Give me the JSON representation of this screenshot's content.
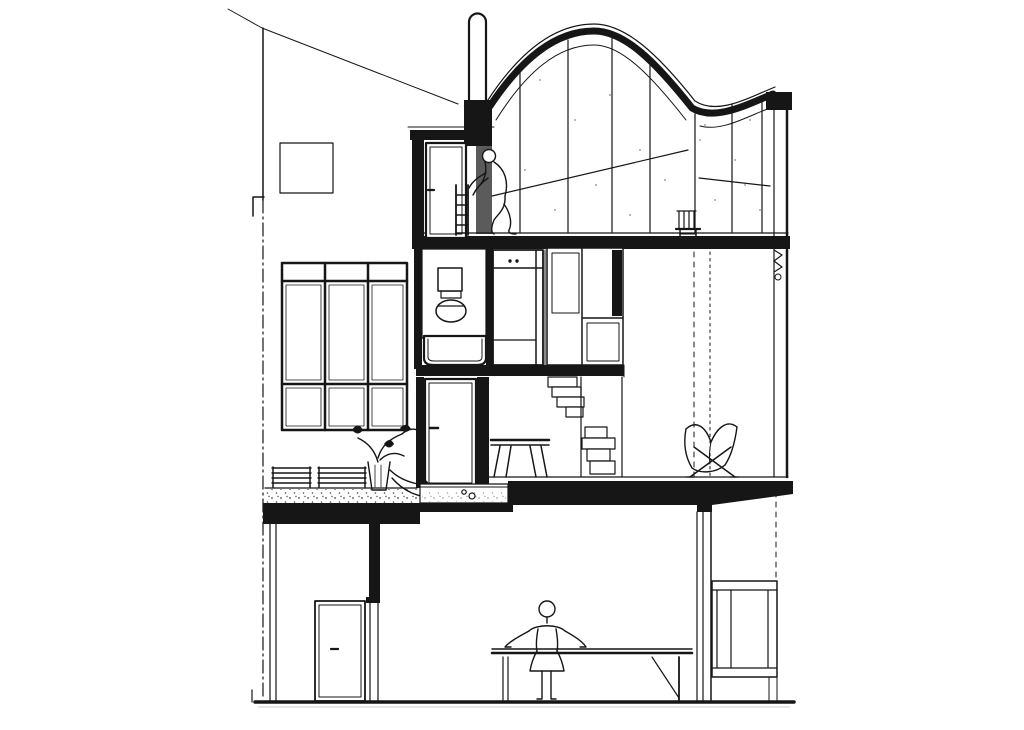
{
  "document": {
    "type": "architectural-section-drawing",
    "description": "Black-and-white architectural cross-section drawing of a narrow multi-storey studio house: curved roof over a double-height glazed studio with a figure on a ladder, mezzanine bathroom with tub and cupboards, mid-level terrace with bench and plant, butterfly chair by the window wall, and a ground-floor dining room with a standing figure at a long table",
    "background": "#ffffff"
  },
  "colors": {
    "paper": "#ffffff",
    "ink": "#161616",
    "shade": "#5b5b5b",
    "tile": "#2e2e2e",
    "stipple": "#474747",
    "dot": "#8a8a8a"
  },
  "drawing": {
    "levels": [
      "rooftop studio with curved roof and full-height glazing",
      "mezzanine bathroom and closets over stair corridor",
      "mid-level terrace and double-height living space",
      "ground-floor dining room"
    ],
    "furniture": [
      "ladder",
      "studio chair",
      "bathtub",
      "toilet",
      "cupboard",
      "wardrobe",
      "stool",
      "bench",
      "planter",
      "butterfly chair",
      "dining table",
      "low cabinet"
    ],
    "figures": [
      "person climbing ladder in studio",
      "person standing at dining table"
    ]
  }
}
